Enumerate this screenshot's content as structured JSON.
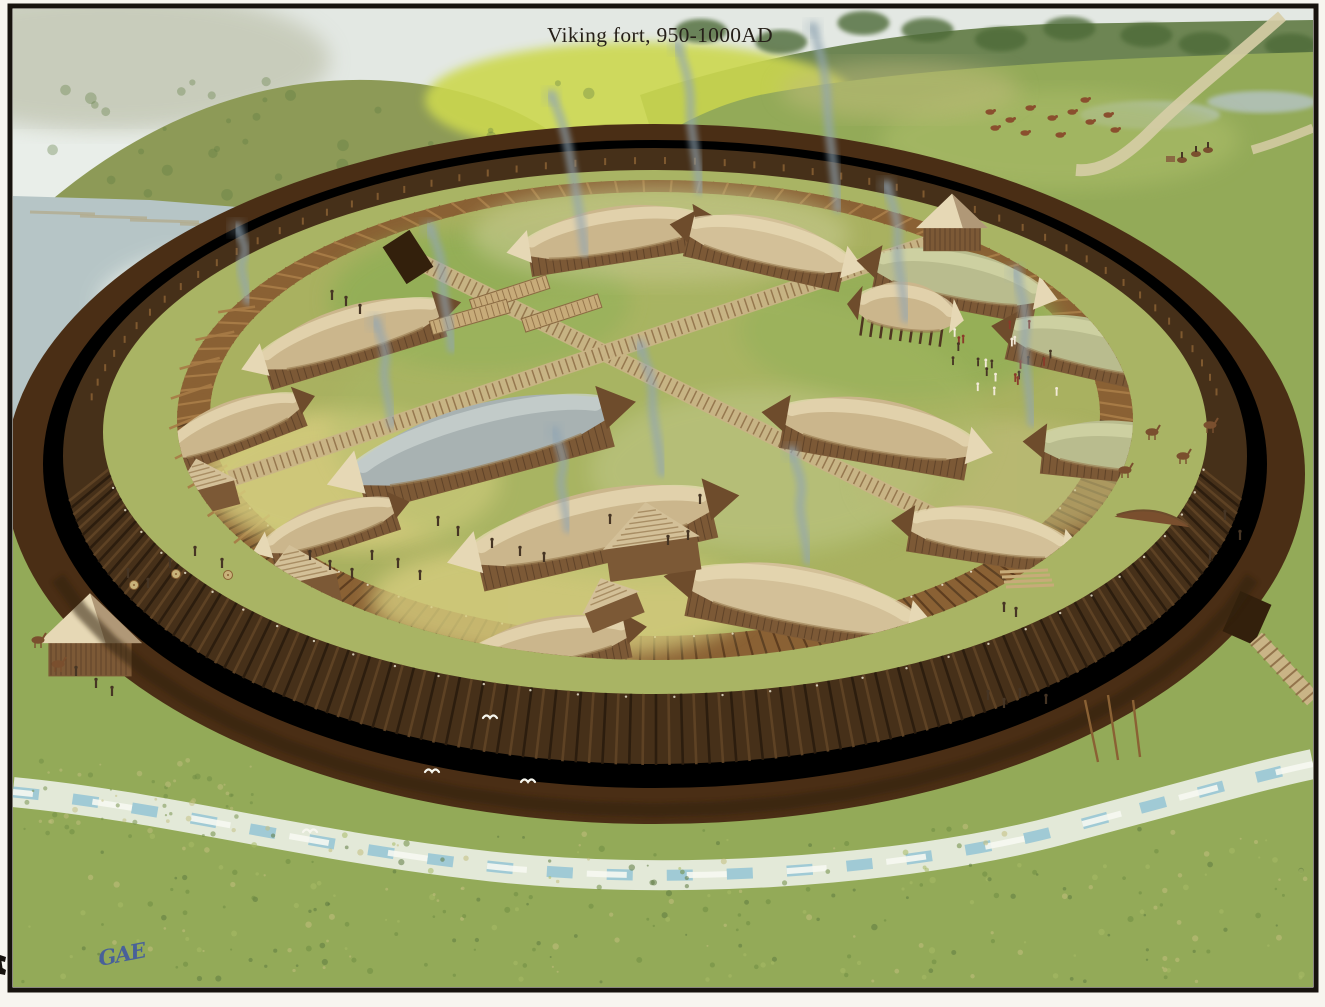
{
  "artwork": {
    "title": "Viking fort, 950-1000AD",
    "signature": "GAE",
    "subject": "aerial watercolour reconstruction of a circular Viking ring fortress",
    "scene_elements": [
      "circular rampart with outer timber wall and inner palisade",
      "surrounding ditch and stream",
      "four gates with gatehouses and east timber causeway",
      "sixteen boat-shaped longhouses in four courtyard quadrants",
      "small huts, timber stacks, plank streets",
      "smoke plumes from hearths",
      "lake and hills behind, grazing cattle and road at top right",
      "tiny figures: guards with shields, market crowd, workers, riders",
      "white gulls in front of the dark wall",
      "cropped printed character at left page margin"
    ]
  },
  "palette": {
    "page": "#f7f5ef",
    "frame": "#17130e",
    "ink": "#262019",
    "signature": "#3c55a5",
    "sky": "#e9eee9",
    "haze": "#dfe5df",
    "hill_far": "#c2c6b2",
    "hill_olive": "#8d9a57",
    "hill_dark": "#5f7a42",
    "hill_bright": "#ccd84f",
    "woods": "#4e6a38",
    "water": "#b6c5c6",
    "water_sheen": "#f2f6ef",
    "shore": "#b2a277",
    "marsh": "#9fc87a",
    "meadow": "#93aa58",
    "meadow_light": "#a8ba66",
    "meadow_dark": "#6f8c44",
    "field_warm": "#c2bd7d",
    "ditch": "#4a2e15",
    "ditch_dark": "#33200c",
    "wall": "#463019",
    "wall_plank_dark": "#2c1d0e",
    "wall_plank_mid": "#5e4224",
    "wall_edge": "#e9e2cc",
    "rampart": "#a9b464",
    "palisade": "#8a6134",
    "palisade_light": "#a77b46",
    "palisade_dark": "#5e3d1f",
    "court": "#a9b160",
    "court_warm": "#d5cc7e",
    "court_green": "#8fae55",
    "court_pale": "#c6c98f",
    "road": "#d6cda6",
    "street": "#c9b486",
    "plank": "#8a6a42",
    "roof_tan": "#cbb68c",
    "roof_tan2": "#d3c098",
    "roof_grey": "#a8b2b2",
    "roof_moss": "#b9bc8e",
    "roof_hi": "#e9ddb8",
    "roof_hi_grey": "#cdd6d3",
    "roof_hi_moss": "#d6d9aa",
    "eave": "#97794f",
    "wood": "#7c5936",
    "wood_dark": "#4e3621",
    "gable_light": "#e6d8b5",
    "gable_dark": "#6e4c2c",
    "smoke": "#92a6b4",
    "stream": "#e7ecdf",
    "stream_blue": "#8fc2d4",
    "stream_white": "#f6f8f2",
    "figure": "#463524",
    "figure_light": "#f3ead8",
    "figure_red": "#8a3b2a",
    "shield": "#c8b27a",
    "cattle": "#8a4f2e",
    "horse": "#7a4f2e",
    "timber": "#c7ab79",
    "bird": "#f6f6ee"
  }
}
